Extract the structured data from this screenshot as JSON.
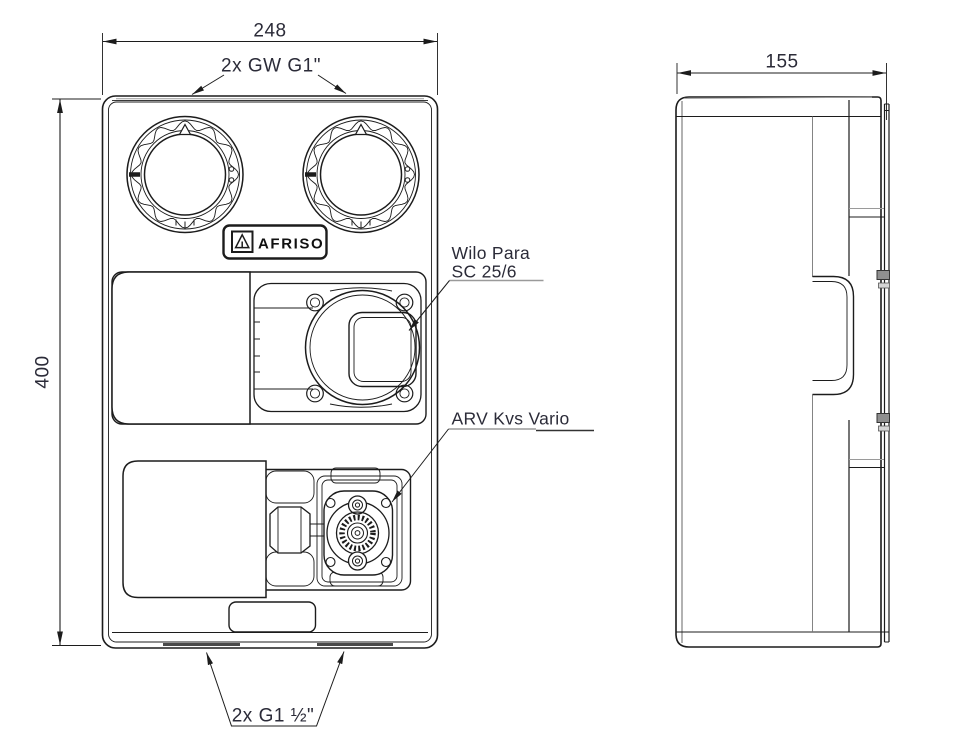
{
  "drawing": {
    "dimensions": {
      "front_width": "248",
      "front_height": "400",
      "side_depth": "155"
    },
    "labels": {
      "top_connections": "2x GW G1\"",
      "pump_line1": "Wilo Para",
      "pump_line2": "SC 25/6",
      "valve": "ARV Kvs Vario",
      "bottom_connections": "2x G1 ½\""
    },
    "logo_text": "AFRISO",
    "colors": {
      "line": "#1c1c1c",
      "seam_gray": "#9a9a9a",
      "annotation_text": "#2b2b38",
      "background": "#ffffff"
    }
  }
}
